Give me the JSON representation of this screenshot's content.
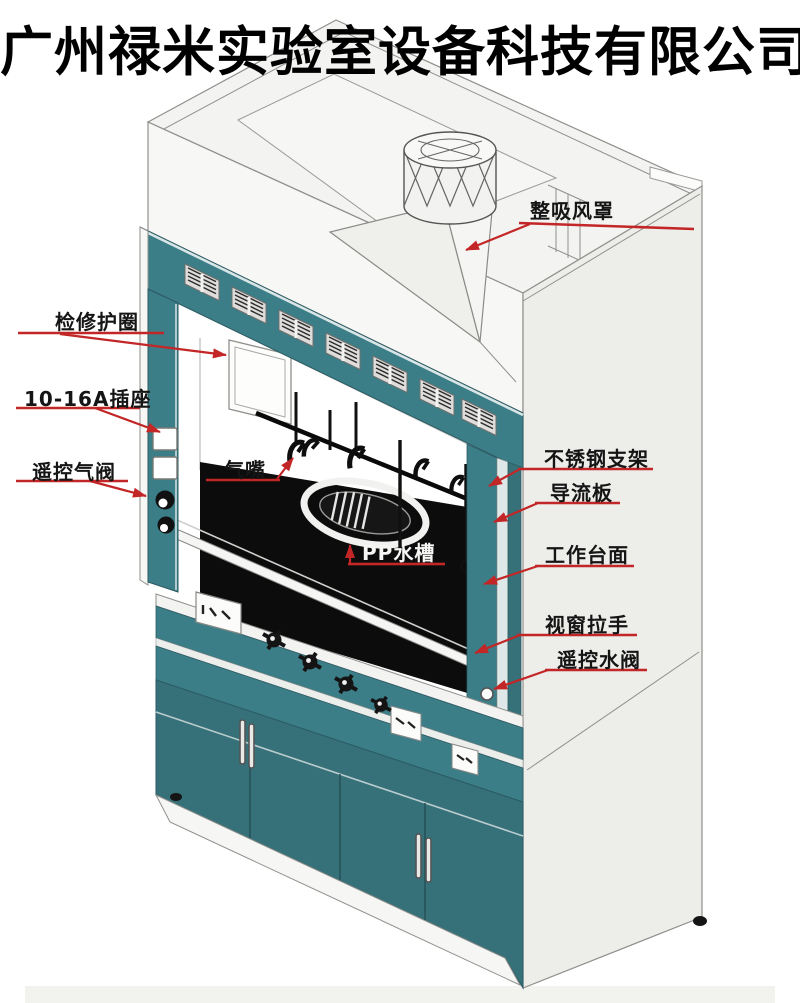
{
  "title": "广州禄米实验室设备科技有限公司",
  "labels": {
    "exhaust_hood": "整吸风罩",
    "service_ring": "检修护圈",
    "power_socket": "10-16A插座",
    "remote_gas_valve": "遥控气阀",
    "gas_nozzle": "气嘴",
    "pp_sink": "PP水槽",
    "stainless_bracket": "不锈钢支架",
    "baffle_plate": "导流板",
    "worktop": "工作台面",
    "sash_handle": "视窗拉手",
    "remote_water_valve": "遥控水阀"
  },
  "theme": {
    "teal": "#3c7e88",
    "teal-dark": "#367079",
    "chamber-black": "#0c0c0c",
    "line-gray": "#8f8f8c",
    "annotation-red": "#c32626",
    "panel-white": "#f4f4f2",
    "side-gray": "#ededea"
  }
}
